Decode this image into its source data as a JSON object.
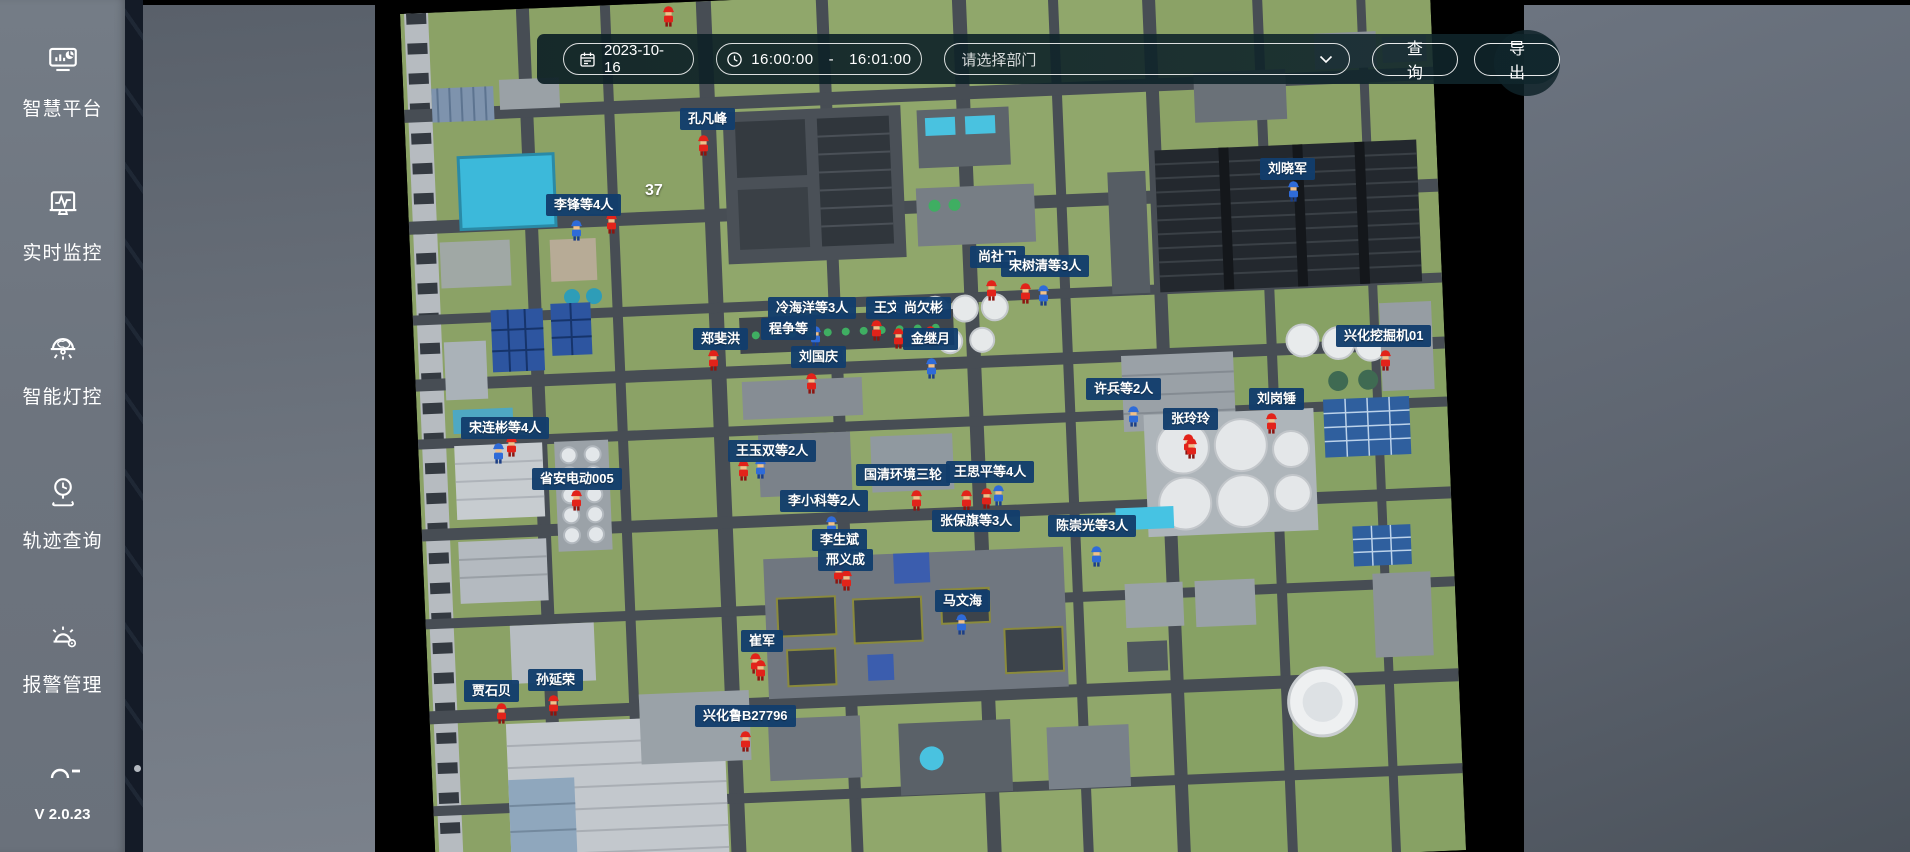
{
  "sidebar": {
    "items": [
      {
        "icon": "dashboard-monitor-icon",
        "label": "智慧平台"
      },
      {
        "icon": "monitor-pulse-icon",
        "label": "实时监控"
      },
      {
        "icon": "smart-lamp-icon",
        "label": "智能灯控"
      },
      {
        "icon": "track-clock-icon",
        "label": "轨迹查询"
      },
      {
        "icon": "alarm-bell-icon",
        "label": "报警管理"
      }
    ],
    "version": "V 2.0.23"
  },
  "toolbar": {
    "date": "2023-10-16",
    "time_start": "16:00:00",
    "time_separator": "-",
    "time_end": "16:01:00",
    "department_placeholder": "请选择部门",
    "query_label": "查 询",
    "export_label": "导 出"
  },
  "map": {
    "count_overlay": {
      "text": "37",
      "x": 645,
      "y": 182
    },
    "labels": [
      {
        "text": "程争等",
        "x": 761,
        "y": 318
      },
      {
        "text": "冷海洋等3人",
        "x": 768,
        "y": 297
      },
      {
        "text": "王文",
        "x": 866,
        "y": 297
      },
      {
        "text": "尚欠彬",
        "x": 896,
        "y": 297
      },
      {
        "text": "尚社卫",
        "x": 970,
        "y": 246
      },
      {
        "text": "宋树清等3人",
        "x": 1001,
        "y": 255
      },
      {
        "text": "孔凡峰",
        "x": 680,
        "y": 108
      },
      {
        "text": "李锋等4人",
        "x": 546,
        "y": 194
      },
      {
        "text": "刘晓军",
        "x": 1260,
        "y": 158
      },
      {
        "text": "金继月",
        "x": 903,
        "y": 328
      },
      {
        "text": "刘国庆",
        "x": 791,
        "y": 346
      },
      {
        "text": "郑斐洪",
        "x": 693,
        "y": 328
      },
      {
        "text": "兴化挖掘机01",
        "x": 1336,
        "y": 325
      },
      {
        "text": "许兵等2人",
        "x": 1086,
        "y": 378
      },
      {
        "text": "刘岗锤",
        "x": 1249,
        "y": 388
      },
      {
        "text": "张玲玲",
        "x": 1163,
        "y": 408
      },
      {
        "text": "宋连彬等4人",
        "x": 461,
        "y": 417
      },
      {
        "text": "省安电动005",
        "x": 532,
        "y": 468
      },
      {
        "text": "王玉双等2人",
        "x": 728,
        "y": 440
      },
      {
        "text": "国清环境三轮",
        "x": 856,
        "y": 464
      },
      {
        "text": "王思平等4人",
        "x": 946,
        "y": 461
      },
      {
        "text": "李小科等2人",
        "x": 780,
        "y": 490
      },
      {
        "text": "张保旗等3人",
        "x": 932,
        "y": 510
      },
      {
        "text": "陈崇光等3人",
        "x": 1048,
        "y": 515
      },
      {
        "text": "邢义成",
        "x": 818,
        "y": 549
      },
      {
        "text": "李生斌",
        "x": 812,
        "y": 529
      },
      {
        "text": "马文海",
        "x": 935,
        "y": 590
      },
      {
        "text": "崔军",
        "x": 741,
        "y": 630
      },
      {
        "text": "贾石贝",
        "x": 464,
        "y": 680
      },
      {
        "text": "孙延荣",
        "x": 528,
        "y": 669
      },
      {
        "text": "兴化鲁B27796",
        "x": 695,
        "y": 705
      }
    ],
    "workers": [
      {
        "x": 662,
        "y": 5,
        "color": "red"
      },
      {
        "x": 697,
        "y": 134,
        "color": "red"
      },
      {
        "x": 570,
        "y": 219,
        "color": "blue"
      },
      {
        "x": 605,
        "y": 212,
        "color": "red"
      },
      {
        "x": 1287,
        "y": 180,
        "color": "blue"
      },
      {
        "x": 985,
        "y": 279,
        "color": "red"
      },
      {
        "x": 1019,
        "y": 282,
        "color": "red"
      },
      {
        "x": 1037,
        "y": 284,
        "color": "blue"
      },
      {
        "x": 809,
        "y": 325,
        "color": "blue"
      },
      {
        "x": 870,
        "y": 319,
        "color": "red"
      },
      {
        "x": 892,
        "y": 327,
        "color": "red"
      },
      {
        "x": 924,
        "y": 325,
        "color": "red"
      },
      {
        "x": 925,
        "y": 357,
        "color": "blue"
      },
      {
        "x": 805,
        "y": 372,
        "color": "red"
      },
      {
        "x": 707,
        "y": 349,
        "color": "red"
      },
      {
        "x": 1379,
        "y": 349,
        "color": "red"
      },
      {
        "x": 1127,
        "y": 405,
        "color": "blue"
      },
      {
        "x": 1265,
        "y": 412,
        "color": "red"
      },
      {
        "x": 1182,
        "y": 433,
        "color": "red"
      },
      {
        "x": 492,
        "y": 442,
        "color": "blue"
      },
      {
        "x": 505,
        "y": 435,
        "color": "red"
      },
      {
        "x": 570,
        "y": 489,
        "color": "red"
      },
      {
        "x": 737,
        "y": 459,
        "color": "red"
      },
      {
        "x": 754,
        "y": 457,
        "color": "blue"
      },
      {
        "x": 910,
        "y": 489,
        "color": "red"
      },
      {
        "x": 960,
        "y": 489,
        "color": "red"
      },
      {
        "x": 980,
        "y": 487,
        "color": "red"
      },
      {
        "x": 992,
        "y": 484,
        "color": "blue"
      },
      {
        "x": 1185,
        "y": 437,
        "color": "red"
      },
      {
        "x": 825,
        "y": 515,
        "color": "blue"
      },
      {
        "x": 832,
        "y": 562,
        "color": "red"
      },
      {
        "x": 840,
        "y": 569,
        "color": "red"
      },
      {
        "x": 1090,
        "y": 545,
        "color": "blue"
      },
      {
        "x": 955,
        "y": 613,
        "color": "blue"
      },
      {
        "x": 749,
        "y": 652,
        "color": "red"
      },
      {
        "x": 495,
        "y": 702,
        "color": "red"
      },
      {
        "x": 547,
        "y": 694,
        "color": "red"
      },
      {
        "x": 739,
        "y": 730,
        "color": "red"
      },
      {
        "x": 754,
        "y": 659,
        "color": "red"
      }
    ]
  }
}
